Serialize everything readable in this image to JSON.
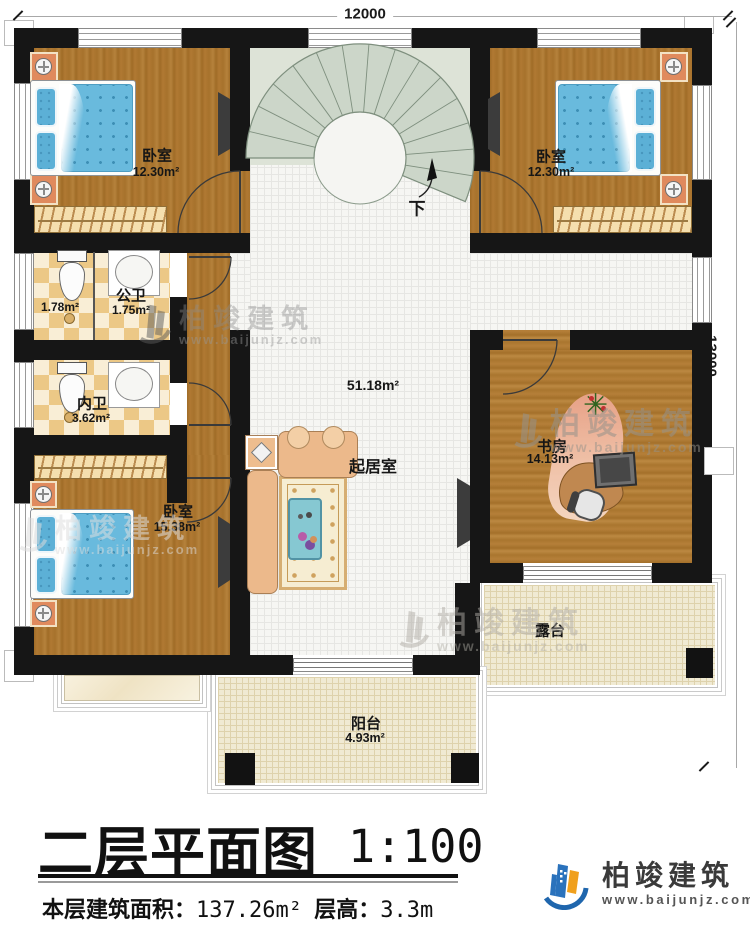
{
  "dimensions": {
    "width": "12000",
    "height": "13000"
  },
  "stairs": {
    "down_label": "下"
  },
  "rooms": {
    "bedroom_top_left": {
      "name": "卧室",
      "area": "12.30m²"
    },
    "bedroom_top_right": {
      "name": "卧室",
      "area": "12.30m²"
    },
    "bedroom_bottom_left": {
      "name": "卧室",
      "area": "15.38m²"
    },
    "public_bath": {
      "name": "公卫",
      "area": "1.75m²",
      "toilet_area": "1.78m²"
    },
    "ensuite_bath": {
      "name": "内卫",
      "area": "3.62m²"
    },
    "living_room": {
      "name": "起居室",
      "area": "51.18m²"
    },
    "study": {
      "name": "书房",
      "area": "14.13m²"
    },
    "terrace": {
      "name": "露台"
    },
    "balcony": {
      "name": "阳台",
      "area": "4.93m²"
    }
  },
  "title_block": {
    "title": "二层平面图",
    "scale": "1:100",
    "floor_area_label": "本层建筑面积：",
    "floor_area_value": "137.26m²",
    "floor_height_label": "层高：",
    "floor_height_value": "3.3m"
  },
  "brand": {
    "name": "柏竣建筑",
    "site": "www.baijunjz.com"
  },
  "watermark": {
    "name": "柏竣建筑",
    "site": "www.baijunjz.com"
  }
}
